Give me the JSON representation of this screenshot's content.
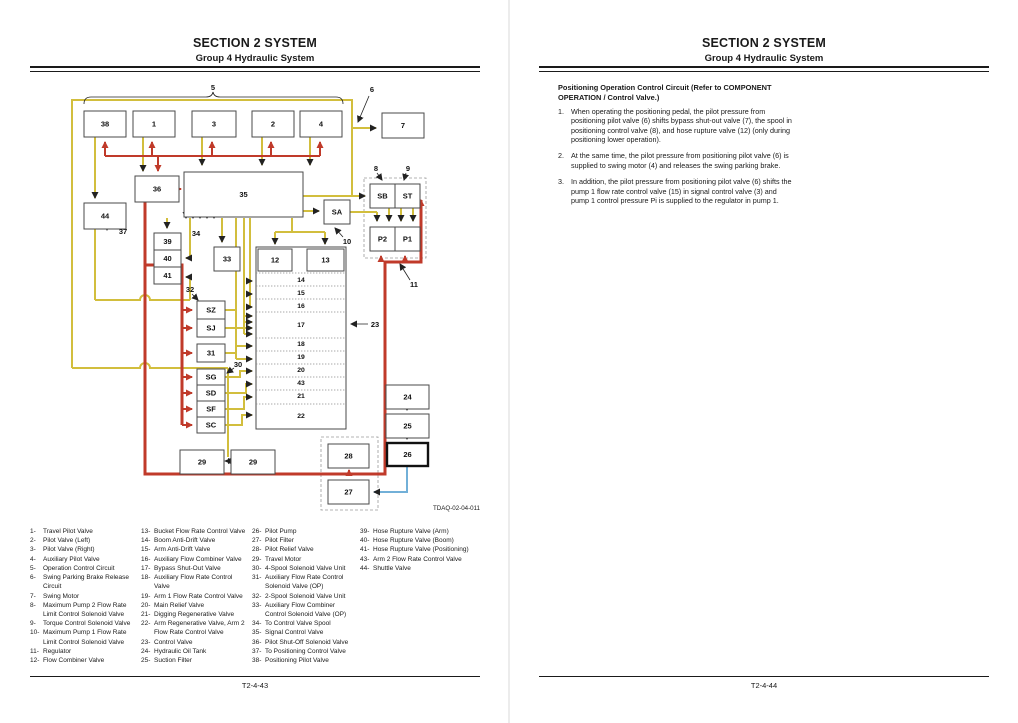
{
  "header": {
    "section": "SECTION 2 SYSTEM",
    "group": "Group 4 Hydraulic System"
  },
  "left_page": {
    "footer": "T2-4-43",
    "figure_code": "TDAQ-02-04-011",
    "legend_columns": [
      [
        {
          "n": "1-",
          "t": "Travel Pilot Valve"
        },
        {
          "n": "2-",
          "t": "Pilot Valve (Left)"
        },
        {
          "n": "3-",
          "t": "Pilot Valve (Right)"
        },
        {
          "n": "4-",
          "t": "Auxiliary Pilot Valve"
        },
        {
          "n": "5-",
          "t": "Operation Control Circuit"
        },
        {
          "n": "6-",
          "t": "Swing Parking Brake Release Circuit"
        },
        {
          "n": "7-",
          "t": "Swing Motor"
        },
        {
          "n": "8-",
          "t": "Maximum Pump 2 Flow Rate Limit Control Solenoid Valve"
        },
        {
          "n": "9-",
          "t": "Torque Control Solenoid Valve"
        },
        {
          "n": "10-",
          "t": "Maximum Pump 1 Flow Rate Limit Control Solenoid Valve"
        },
        {
          "n": "11-",
          "t": "Regulator"
        },
        {
          "n": "12-",
          "t": "Flow Combiner Valve"
        }
      ],
      [
        {
          "n": "13-",
          "t": "Bucket Flow Rate Control Valve"
        },
        {
          "n": "14-",
          "t": "Boom Anti-Drift Valve"
        },
        {
          "n": "15-",
          "t": "Arm Anti-Drift Valve"
        },
        {
          "n": "16-",
          "t": "Auxiliary Flow Combiner Valve"
        },
        {
          "n": "17-",
          "t": "Bypass Shut-Out Valve"
        },
        {
          "n": "18-",
          "t": "Auxiliary Flow Rate Control Valve"
        },
        {
          "n": "19-",
          "t": "Arm 1 Flow Rate Control Valve"
        },
        {
          "n": "20-",
          "t": "Main Relief Valve"
        },
        {
          "n": "21-",
          "t": "Digging Regenerative Valve"
        },
        {
          "n": "22-",
          "t": "Arm Regenerative Valve, Arm 2 Flow Rate Control Valve"
        },
        {
          "n": "23-",
          "t": "Control Valve"
        },
        {
          "n": "24-",
          "t": "Hydraulic Oil Tank"
        },
        {
          "n": "25-",
          "t": "Suction Filter"
        }
      ],
      [
        {
          "n": "26-",
          "t": "Pilot Pump"
        },
        {
          "n": "27-",
          "t": "Pilot Filter"
        },
        {
          "n": "28-",
          "t": "Pilot Relief Valve"
        },
        {
          "n": "29-",
          "t": "Travel Motor"
        },
        {
          "n": "30-",
          "t": "4-Spool Solenoid Valve Unit"
        },
        {
          "n": "31-",
          "t": "Auxiliary Flow Rate Control Solenoid Valve (OP)"
        },
        {
          "n": "32-",
          "t": "2-Spool Solenoid Valve Unit"
        },
        {
          "n": "33-",
          "t": "Auxiliary Flow Combiner Control Solenoid Valve (OP)"
        },
        {
          "n": "34-",
          "t": "To Control Valve Spool"
        },
        {
          "n": "35-",
          "t": "Signal Control Valve"
        },
        {
          "n": "36-",
          "t": "Pilot Shut-Off Solenoid Valve"
        },
        {
          "n": "37-",
          "t": "To Positioning Control Valve"
        },
        {
          "n": "38-",
          "t": "Positioning Pilot Valve"
        }
      ],
      [
        {
          "n": "39-",
          "t": "Hose Rupture Valve (Arm)"
        },
        {
          "n": "40-",
          "t": "Hose Rupture Valve (Boom)"
        },
        {
          "n": "41-",
          "t": "Hose Rupture Valve (Positioning)"
        },
        {
          "n": "43-",
          "t": "Arm 2 Flow Rate Control Valve"
        },
        {
          "n": "44-",
          "t": "Shuttle Valve"
        }
      ]
    ]
  },
  "right_page": {
    "footer": "T2-4-44",
    "heading": "Positioning Operation Control Circuit (Refer to COMPONENT OPERATION / Control Valve.)",
    "items": [
      {
        "num": "1.",
        "text": "When operating the positioning pedal, the pilot pressure from positioning pilot valve (6) shifts bypass shut-out valve (7), the spool in positioning control valve (8), and hose rupture valve (12) (only during positioning lower operation)."
      },
      {
        "num": "2.",
        "text": "At the same time, the pilot pressure from positioning pilot valve (6) is supplied to swing motor (4) and releases the swing parking brake."
      },
      {
        "num": "3.",
        "text": "In addition, the pilot pressure from positioning pilot valve (6) shifts the pump 1 flow rate control valve (15) in signal control valve (3) and pump 1 control pressure Pi is supplied to the regulator in pump 1."
      }
    ]
  },
  "diagram": {
    "colors": {
      "pilot_line": "#d2be3d",
      "main_line": "#c03a2a",
      "drain_line": "#72b0d8"
    },
    "boxes": [
      {
        "label": "38",
        "x": 84,
        "y": 111,
        "w": 42,
        "h": 26
      },
      {
        "label": "1",
        "x": 133,
        "y": 111,
        "w": 42,
        "h": 26
      },
      {
        "label": "3",
        "x": 192,
        "y": 111,
        "w": 44,
        "h": 26
      },
      {
        "label": "2",
        "x": 252,
        "y": 111,
        "w": 42,
        "h": 26
      },
      {
        "label": "4",
        "x": 300,
        "y": 111,
        "w": 42,
        "h": 26
      },
      {
        "label": "7",
        "x": 382,
        "y": 113,
        "w": 42,
        "h": 25
      },
      {
        "label": "36",
        "x": 135,
        "y": 176,
        "w": 44,
        "h": 26
      },
      {
        "label": "35",
        "x": 184,
        "y": 172,
        "w": 119,
        "h": 45
      },
      {
        "label": "44",
        "x": 84,
        "y": 203,
        "w": 42,
        "h": 26
      },
      {
        "label": "39",
        "x": 154,
        "y": 233,
        "w": 27,
        "h": 17
      },
      {
        "label": "40",
        "x": 154,
        "y": 250,
        "w": 27,
        "h": 17
      },
      {
        "label": "41",
        "x": 154,
        "y": 267,
        "w": 27,
        "h": 17
      },
      {
        "label": "33",
        "x": 214,
        "y": 247,
        "w": 26,
        "h": 24
      },
      {
        "label": "SA",
        "x": 324,
        "y": 200,
        "w": 26,
        "h": 24
      },
      {
        "label": "SB",
        "x": 370,
        "y": 184,
        "w": 25,
        "h": 24
      },
      {
        "label": "ST",
        "x": 395,
        "y": 184,
        "w": 25,
        "h": 24
      },
      {
        "label": "P2",
        "x": 370,
        "y": 227,
        "w": 25,
        "h": 24
      },
      {
        "label": "P1",
        "x": 395,
        "y": 227,
        "w": 25,
        "h": 24
      },
      {
        "label": "12",
        "x": 258,
        "y": 249,
        "w": 34,
        "h": 22
      },
      {
        "label": "13",
        "x": 307,
        "y": 249,
        "w": 37,
        "h": 22
      },
      {
        "label": "SZ",
        "x": 197,
        "y": 301,
        "w": 28,
        "h": 18
      },
      {
        "label": "SJ",
        "x": 197,
        "y": 319,
        "w": 28,
        "h": 18
      },
      {
        "label": "31",
        "x": 197,
        "y": 344,
        "w": 28,
        "h": 18
      },
      {
        "label": "SG",
        "x": 197,
        "y": 369,
        "w": 28,
        "h": 16
      },
      {
        "label": "SD",
        "x": 197,
        "y": 385,
        "w": 28,
        "h": 16
      },
      {
        "label": "SF",
        "x": 197,
        "y": 401,
        "w": 28,
        "h": 16
      },
      {
        "label": "SC",
        "x": 197,
        "y": 417,
        "w": 28,
        "h": 16
      },
      {
        "label": "29",
        "x": 180,
        "y": 450,
        "w": 44,
        "h": 24
      },
      {
        "label": "29",
        "x": 231,
        "y": 450,
        "w": 44,
        "h": 24
      },
      {
        "label": "24",
        "x": 386,
        "y": 385,
        "w": 43,
        "h": 24
      },
      {
        "label": "25",
        "x": 386,
        "y": 414,
        "w": 43,
        "h": 24
      },
      {
        "label": "26",
        "x": 387,
        "y": 443,
        "w": 41,
        "h": 23,
        "thick": true
      },
      {
        "label": "28",
        "x": 328,
        "y": 444,
        "w": 41,
        "h": 24
      },
      {
        "label": "27",
        "x": 328,
        "y": 480,
        "w": 41,
        "h": 24
      }
    ],
    "valve_block": {
      "x": 256,
      "y": 247,
      "w": 90,
      "h": 182,
      "dividers": [
        273,
        286,
        299,
        312,
        338,
        351,
        364,
        377,
        390,
        404
      ],
      "rows": [
        {
          "label": "14",
          "y": 282
        },
        {
          "label": "15",
          "y": 295
        },
        {
          "label": "16",
          "y": 308
        },
        {
          "label": "17",
          "y": 327
        },
        {
          "label": "18",
          "y": 346
        },
        {
          "label": "19",
          "y": 359
        },
        {
          "label": "20",
          "y": 372
        },
        {
          "label": "43",
          "y": 385
        },
        {
          "label": "21",
          "y": 398
        },
        {
          "label": "22",
          "y": 418
        }
      ]
    },
    "callouts": [
      {
        "label": "5",
        "x": 213,
        "y": 90
      },
      {
        "label": "6",
        "x": 372,
        "y": 92
      },
      {
        "label": "8",
        "x": 376,
        "y": 171
      },
      {
        "label": "9",
        "x": 408,
        "y": 171
      },
      {
        "label": "10",
        "x": 347,
        "y": 244
      },
      {
        "label": "11",
        "x": 414,
        "y": 287
      },
      {
        "label": "23",
        "x": 375,
        "y": 327
      },
      {
        "label": "32",
        "x": 190,
        "y": 292
      },
      {
        "label": "30",
        "x": 238,
        "y": 367
      },
      {
        "label": "34",
        "x": 196,
        "y": 236
      },
      {
        "label": "37",
        "x": 123,
        "y": 234
      }
    ]
  }
}
